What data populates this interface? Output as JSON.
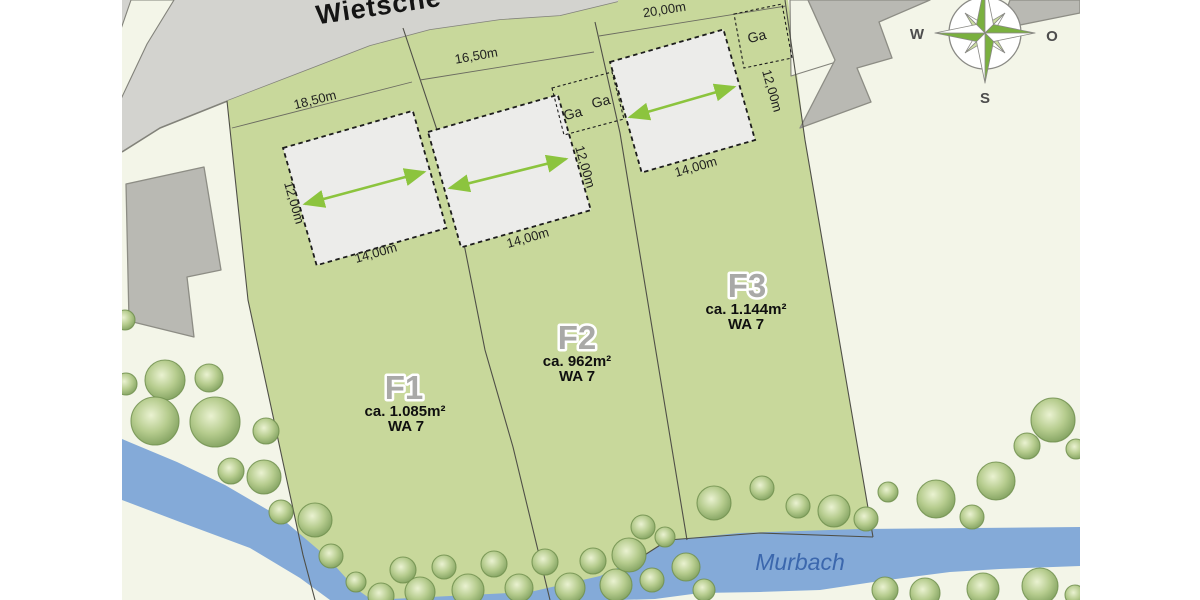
{
  "street": {
    "label": "Wietsche"
  },
  "stream": {
    "label": "Murbach"
  },
  "compass": {
    "west": "W",
    "east": "O",
    "south": "S"
  },
  "plots": [
    {
      "id": "F1",
      "area": "ca. 1.085m²",
      "zone": "WA 7",
      "frontage": "18,50m",
      "building_width": "14,00m",
      "building_depth": "12,00m"
    },
    {
      "id": "F2",
      "area": "ca. 962m²",
      "zone": "WA 7",
      "frontage": "16,50m",
      "building_width": "14,00m",
      "building_depth": "12,00m"
    },
    {
      "id": "F3",
      "area": "ca. 1.144m²",
      "zone": "WA 7",
      "frontage": "20,00m",
      "building_width": "14,00m",
      "building_depth": "12,00m"
    }
  ],
  "garages": [
    "Ga",
    "Ga",
    "Ga"
  ],
  "colors": {
    "map_bg": "#f3f5e8",
    "street": "#d3d3cf",
    "street_edge": "#82827a",
    "parcel_gray": "#b9b9b3",
    "parcel_gray_edge": "#8d8d85",
    "plot_green": "#c8d89b",
    "boundary": "#4f4f47",
    "building_fill": "#ececea",
    "building_edge": "#1c1c1c",
    "dim_line": "#6b6b60",
    "arrow_green": "#8cc43e",
    "stream_blue": "#84aad8",
    "stream_text": "#3b67ad",
    "tree_edge": "#71904f",
    "label_gray": "#a9a9a7",
    "text_dark": "#141414",
    "compass_green": "#7ab03f",
    "compass_light": "#cde0a2",
    "compass_edge": "#8a8a85",
    "compass_text": "#4d4d4d"
  }
}
